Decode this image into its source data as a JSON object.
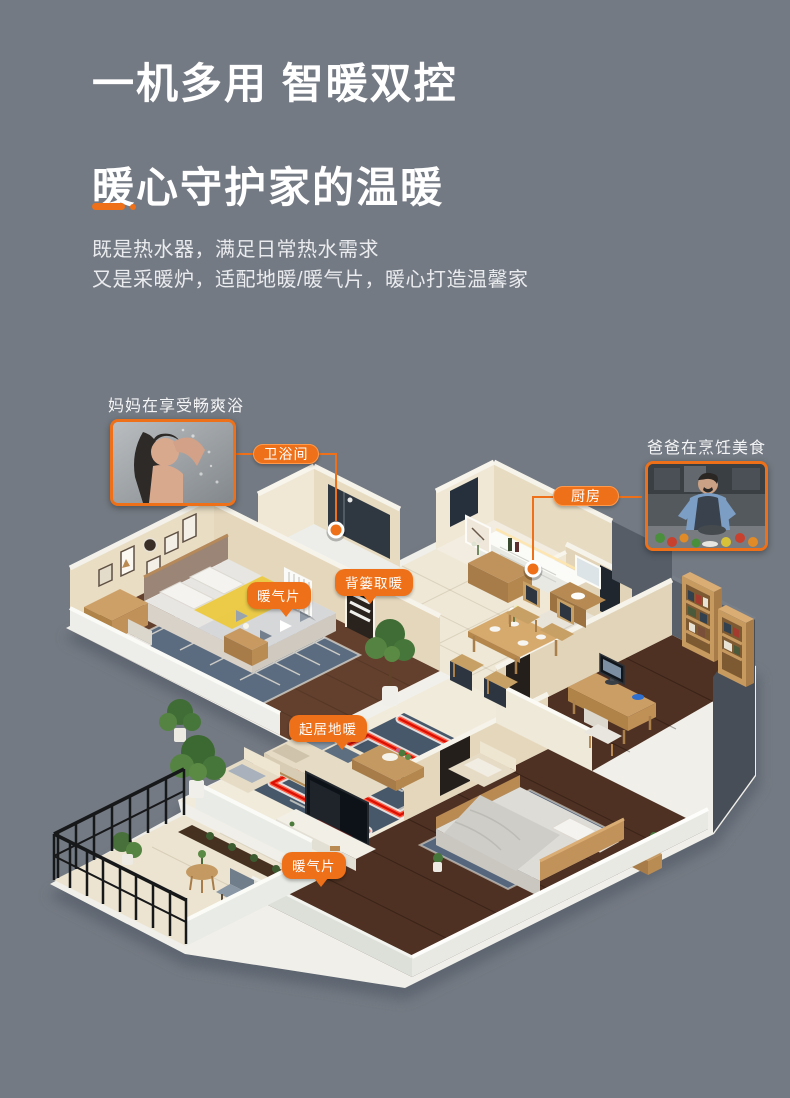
{
  "page": {
    "background": "#747a83",
    "accent": "#ee7018"
  },
  "headline": {
    "line1": "一机多用 智暖双控",
    "line2": "暖心守护家的温暖"
  },
  "subtitle": {
    "line1": "既是热水器，满足日常热水需求",
    "line2": "又是采暖炉，适配地暖/暖气片，暖心打造温馨家"
  },
  "scene": {
    "mom_caption": "妈妈在享受畅爽浴",
    "dad_caption": "爸爸在烹饪美食",
    "tag_bathroom": "卫浴间",
    "tag_kitchen": "厨房",
    "callout_radiator_top": "暖气片",
    "callout_towel_warmer": "背篓取暖",
    "callout_living_floor_heating": "起居地暖",
    "callout_radiator_bottom": "暖气片"
  }
}
